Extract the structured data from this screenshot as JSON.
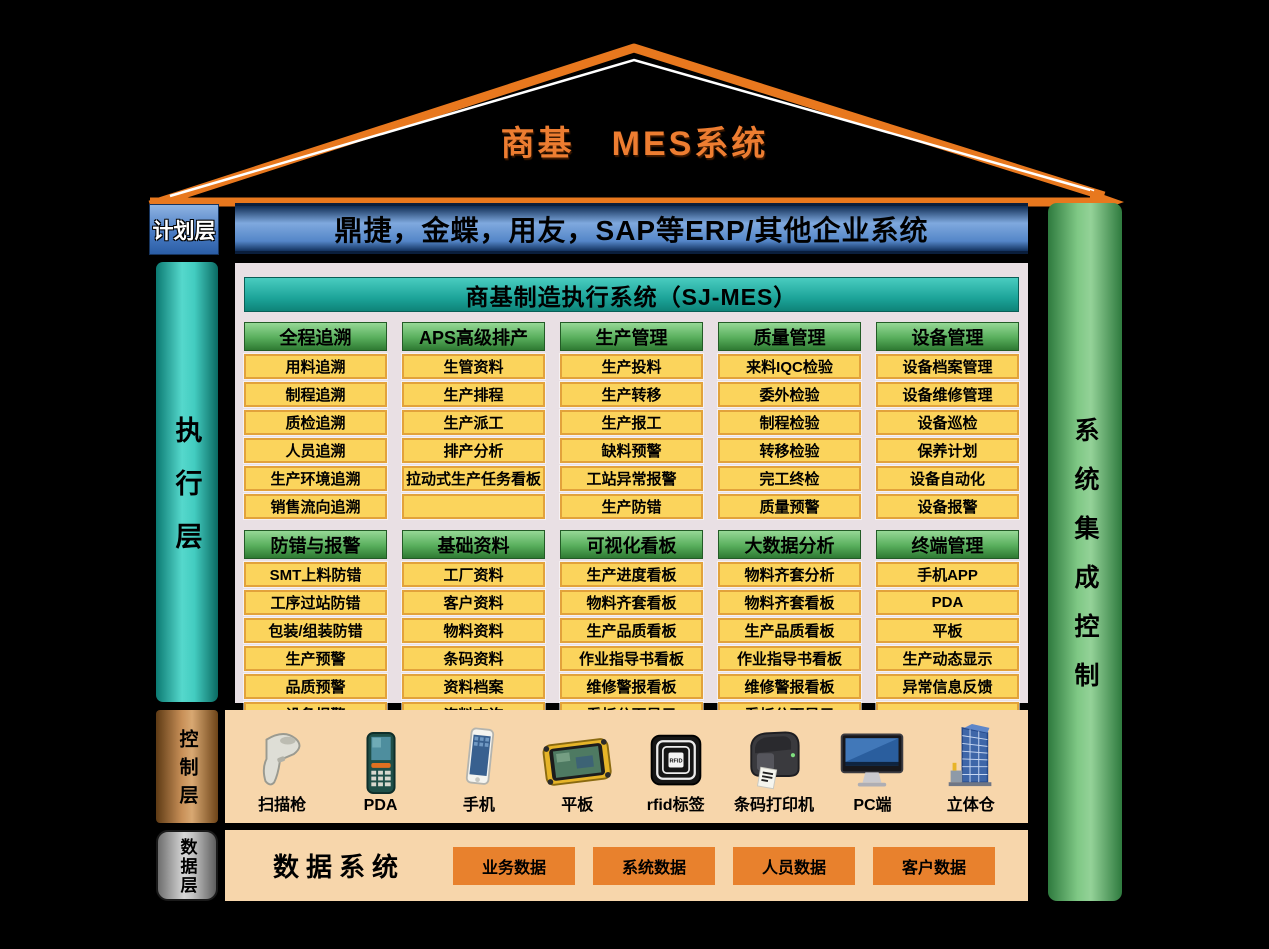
{
  "roof": {
    "title": "商基　MES系统"
  },
  "left_labels": {
    "plan": "计划层",
    "execution": "执行层",
    "control": "控制层",
    "data": "数据层"
  },
  "plan_layer": {
    "erp_text": "鼎捷，金蝶，用友，SAP等ERP/其他企业系统"
  },
  "execution_layer": {
    "header": "商基制造执行系统（SJ-MES）",
    "modules": [
      {
        "title": "全程追溯",
        "items": [
          "用料追溯",
          "制程追溯",
          "质检追溯",
          "人员追溯",
          "生产环境追溯",
          "销售流向追溯"
        ]
      },
      {
        "title": "APS高级排产",
        "items": [
          "生管资料",
          "生产排程",
          "生产派工",
          "排产分析",
          "拉动式生产任务看板",
          ""
        ]
      },
      {
        "title": "生产管理",
        "items": [
          "生产投料",
          "生产转移",
          "生产报工",
          "缺料预警",
          "工站异常报警",
          "生产防错"
        ]
      },
      {
        "title": "质量管理",
        "items": [
          "来料IQC检验",
          "委外检验",
          "制程检验",
          "转移检验",
          "完工终检",
          "质量预警"
        ]
      },
      {
        "title": "设备管理",
        "items": [
          "设备档案管理",
          "设备维修管理",
          "设备巡检",
          "保养计划",
          "设备自动化",
          "设备报警"
        ]
      },
      {
        "title": "防错与报警",
        "items": [
          "SMT上料防错",
          "工序过站防错",
          "包装/组装防错",
          "生产预警",
          "品质预警",
          "设备报警"
        ]
      },
      {
        "title": "基础资料",
        "items": [
          "工厂资料",
          "客户资料",
          "物料资料",
          "条码资料",
          "资料档案",
          "资料查询"
        ]
      },
      {
        "title": "可视化看板",
        "items": [
          "生产进度看板",
          "物料齐套看板",
          "生产品质看板",
          "作业指导书看板",
          "维修警报看板",
          "看板分页显示"
        ]
      },
      {
        "title": "大数据分析",
        "items": [
          "物料齐套分析",
          "物料齐套看板",
          "生产品质看板",
          "作业指导书看板",
          "维修警报看板",
          "看板分页显示"
        ]
      },
      {
        "title": "终端管理",
        "items": [
          "手机APP",
          "PDA",
          "平板",
          "生产动态显示",
          "异常信息反馈",
          ""
        ]
      }
    ]
  },
  "control_layer": {
    "devices": [
      {
        "label": "扫描枪"
      },
      {
        "label": "PDA"
      },
      {
        "label": "手机"
      },
      {
        "label": "平板"
      },
      {
        "label": "rfid标签"
      },
      {
        "label": "条码打印机"
      },
      {
        "label": "PC端"
      },
      {
        "label": "立体仓"
      }
    ]
  },
  "data_layer": {
    "title": "数据系统",
    "boxes": [
      "业务数据",
      "系统数据",
      "人员数据",
      "客户数据"
    ]
  },
  "right_bar": {
    "label": "系统集成控制"
  },
  "colors": {
    "roof_orange": "#E8781E",
    "title_orange": "#ED7D31",
    "erp_blue": "#5486C8",
    "teal": "#1CA398",
    "module_green": "#58AE5C",
    "item_yellow": "#FBD45C",
    "item_border": "#E2A23B",
    "panel_bg": "#E9E0E4",
    "peach_bg": "#F7D6AB",
    "data_orange": "#E8812D",
    "right_green": "#7FC885"
  }
}
